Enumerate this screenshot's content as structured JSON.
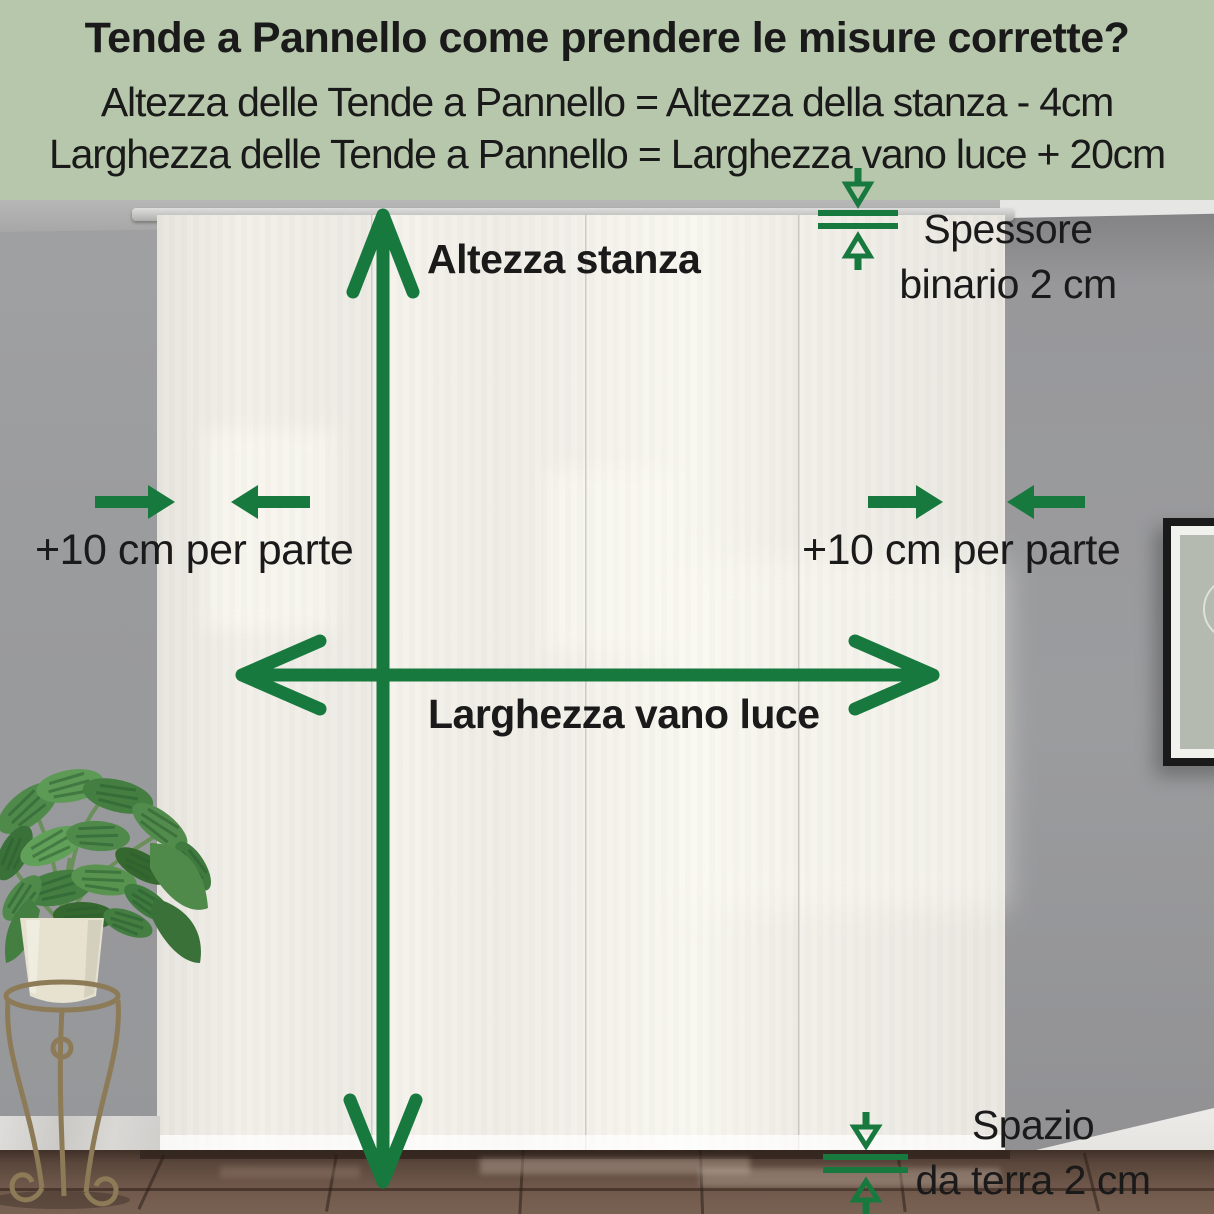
{
  "header": {
    "title": "Tende a Pannello come prendere le misure corrette?",
    "formula_height": "Altezza delle Tende a Pannello = Altezza della stanza - 4cm",
    "formula_width": "Larghezza delle Tende a Pannello = Larghezza vano luce + 20cm"
  },
  "labels": {
    "room_height": "Altezza stanza",
    "opening_width": "Larghezza vano luce",
    "side_margin_left": "+10 cm per parte",
    "side_margin_right": "+10 cm per parte",
    "track_thickness_line1": "Spessore",
    "track_thickness_line2": "binario 2 cm",
    "floor_gap_line1": "Spazio",
    "floor_gap_line2": "da terra 2 cm"
  },
  "colors": {
    "header_background": "#b7c7ab",
    "annotation_green": "#17793d",
    "text_dark": "#1a1a1a"
  },
  "icons": {
    "room_height_arrow": "double-headed-vertical-arrow",
    "opening_width_arrow": "double-headed-horizontal-arrow",
    "side_margin_arrows_left": "converging-horizontal-arrows",
    "side_margin_arrows_right": "converging-horizontal-arrows",
    "track_thickness_marker": "double-rule-with-outline-arrows",
    "floor_gap_marker": "double-rule-with-outline-arrows"
  },
  "scene": {
    "curtain_panels": 4,
    "wall_color": "#9a9b9d",
    "curtain_color": "#f1efe8",
    "floor_color": "#6e574a"
  }
}
